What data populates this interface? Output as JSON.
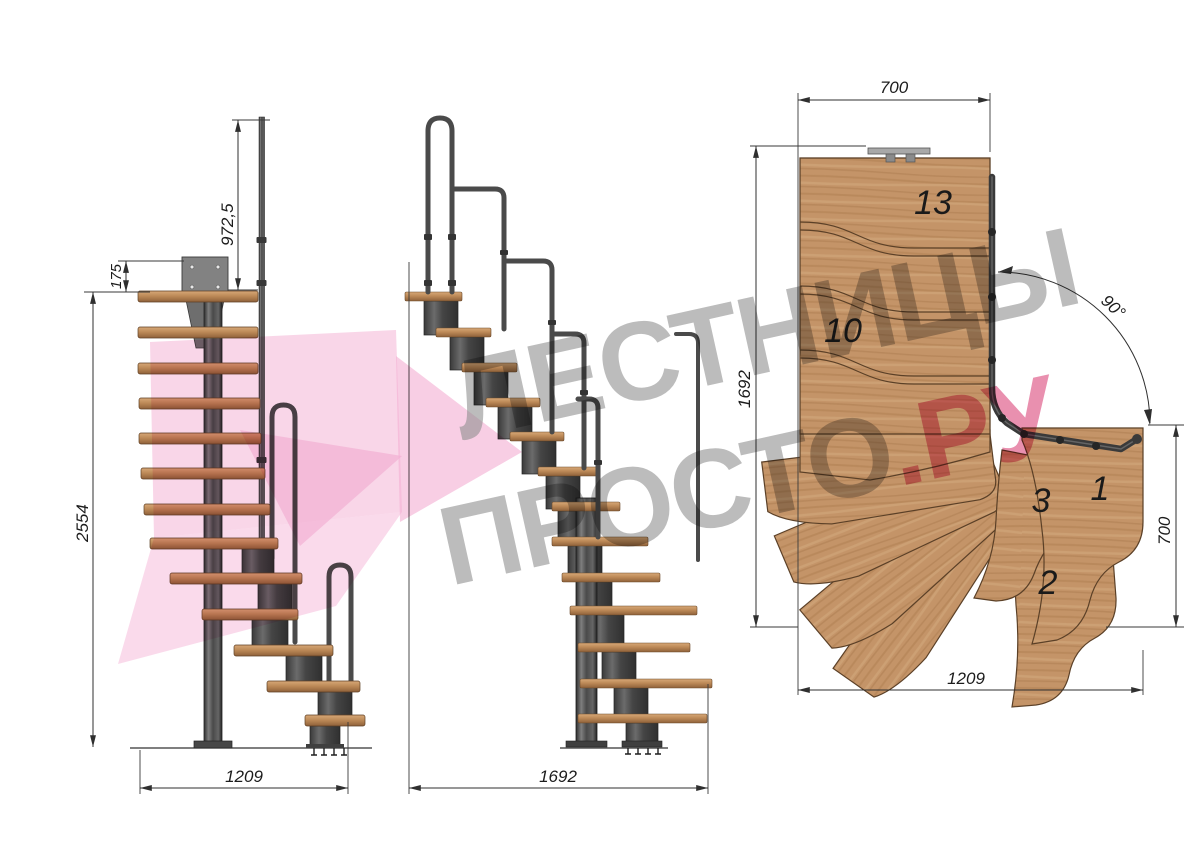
{
  "drawing_title": "Модульная лестница с поворотом 90° — чертёж в трёх проекциях",
  "watermark": {
    "line1": "ЛЕСТНИЦЫ",
    "line2": "ПРОСТО",
    "line2_suffix": ".РУ",
    "text_color": "#8f8f8f",
    "accent_color": "#d6336c",
    "logo_color": "#f3aed2"
  },
  "front_view": {
    "dim_total_height": "2554",
    "dim_rail_height": "972,5",
    "dim_top_offset": "175",
    "dim_width": "1209"
  },
  "side_view": {
    "dim_length": "1692"
  },
  "plan_view": {
    "dim_top_width": "700",
    "dim_depth": "1692",
    "dim_right_depth": "700",
    "dim_bottom_width": "1209",
    "turn_angle": "90°",
    "step_labels": {
      "top": "13",
      "mid": "10",
      "turn": "3",
      "entry_first": "1",
      "entry_second": "2"
    }
  },
  "colors": {
    "wood": "#c49468",
    "wood_outline": "#5b4027",
    "steel_dark": "#3a3a3a",
    "steel_mid": "#4f4f4f",
    "dimension": "#2f2f2f",
    "background": "#ffffff"
  }
}
